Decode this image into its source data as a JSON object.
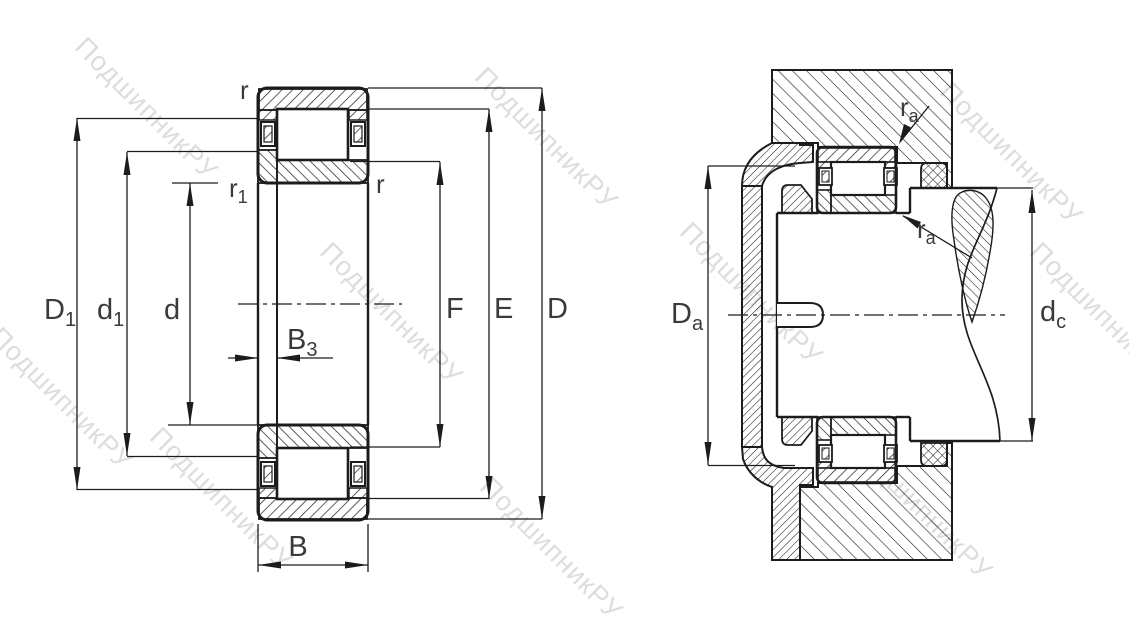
{
  "watermark": {
    "text": "ПодшипникРУ"
  },
  "left_view": {
    "labels": {
      "r_top": "r",
      "r1": {
        "base": "r",
        "sub": "1"
      },
      "r_inner": "r",
      "D1": {
        "base": "D",
        "sub": "1"
      },
      "d1": {
        "base": "d",
        "sub": "1"
      },
      "d": "d",
      "B3": {
        "base": "B",
        "sub": "3"
      },
      "B": "B",
      "F": "F",
      "E": "E",
      "D": "D"
    }
  },
  "right_view": {
    "labels": {
      "ra_top": {
        "base": "r",
        "sub": "a"
      },
      "ra_bottom": {
        "base": "r",
        "sub": "a"
      },
      "Da": {
        "base": "D",
        "sub": "a"
      },
      "dc": {
        "base": "d",
        "sub": "c"
      }
    }
  },
  "colors": {
    "line": "#1c1c1c",
    "label": "#3a3a3a",
    "watermark": "#c9c9c9"
  }
}
